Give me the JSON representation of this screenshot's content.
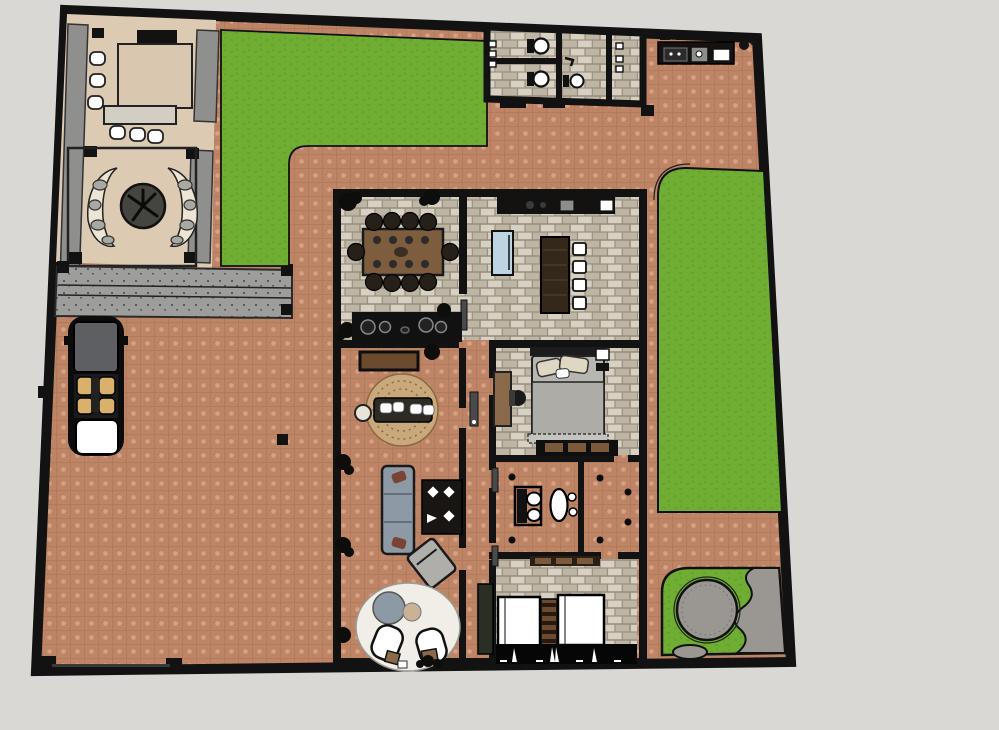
{
  "scene": {
    "description": "Top-down rendered floor plan of a walled residential lot with house, patio, lawns, driveway and garden",
    "view": "plan-top-view",
    "visible_text": "none"
  },
  "inventory": {
    "outdoor": [
      "boundary-wall",
      "terracotta-paving",
      "top-lawn",
      "right-lawn",
      "patio",
      "courtyard-tree",
      "rock-crescent-planters",
      "grill",
      "patio-table",
      "patio-bench",
      "patio-stools",
      "planter-strips",
      "gray-walkway",
      "driveway",
      "parked-car",
      "entry-gate",
      "outdoor-kitchen-counter",
      "guest-bathroom-block",
      "zen-pool-garden"
    ],
    "house_rooms": [
      "dining-room",
      "kitchen",
      "living-room",
      "master-bedroom",
      "bathroom",
      "twin-bedroom",
      "hallway"
    ],
    "dining_room": [
      "dining-table",
      "dining-chairs-10",
      "corner-plants",
      "cooktop-counter"
    ],
    "kitchen": [
      "wall-counter",
      "refrigerator",
      "island-bench",
      "bar-stools-4"
    ],
    "living_room": [
      "sideboard",
      "round-rug",
      "cushion-bench",
      "side-table",
      "sofa",
      "coffee-table",
      "lounge-chair",
      "white-rug",
      "bean-bag",
      "organic-loungers",
      "small-tables",
      "wall-plants"
    ],
    "master_bedroom": [
      "double-bed",
      "pillows",
      "desk",
      "desk-chair",
      "nightstand",
      "wardrobe"
    ],
    "bathroom": [
      "toilet",
      "pedestal-sink",
      "floor-dots"
    ],
    "twin_bedroom": [
      "single-bed-left",
      "single-bed-right",
      "ladder-shelf",
      "storage-bench",
      "curtain-band"
    ],
    "guest_bathrooms": [
      "toilet-1",
      "toilet-2",
      "toilet-3",
      "wall-fixtures",
      "door-mats"
    ],
    "zen_garden": [
      "round-pond",
      "gravel-blobs",
      "lawn-patch"
    ],
    "car": [
      "roof",
      "seats",
      "console",
      "trunk",
      "mirrors"
    ]
  },
  "colors": {
    "background": "#d9d8d4",
    "wall": "#121212",
    "terracotta_base": "#bd8466",
    "terracotta_dot": "#d7a183",
    "terracotta_line": "#aa7154",
    "grass": "#6fae33",
    "grass_dark": "#66a22d",
    "patio_floor": "#dccab3",
    "walkway": "#9d9d9b",
    "walkway_speck": "#59595a",
    "planter_gray": "#8f8f8d",
    "stone_light": "#d8d1c3",
    "stone_mid": "#beb5a4",
    "stone_line": "#98907e",
    "cream": "#ece4d4",
    "rock_gray": "#a9a9a1",
    "tree_dark": "#45453f",
    "table_wood": "#7d5d3e",
    "chair_dark": "#262019",
    "island_wood": "#33281a",
    "fridge_blue": "#bed4e2",
    "white": "#ffffff",
    "sofa_gray": "#8d9aa6",
    "rug_tan": "#c9a87c",
    "rug_white": "#f1eee8",
    "bed_duvet": "#b7b6b0",
    "pillow_beige": "#ded7c2",
    "car_roof": "#5e5f62",
    "car_seat": "#d9b06c",
    "zen_gray": "#9a9792",
    "door_wood": "#8a6a4a",
    "bench_green": "#2a2f26",
    "ladder_wood": "#6b4a2e"
  }
}
